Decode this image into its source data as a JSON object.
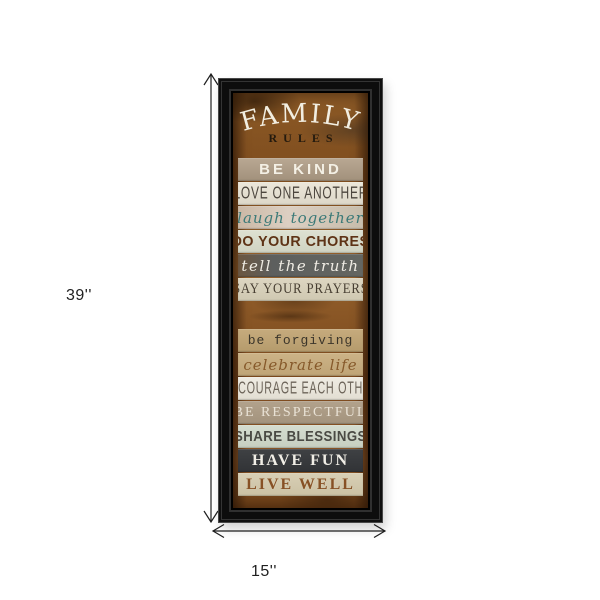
{
  "page": {
    "background": "#ffffff"
  },
  "dimensions": {
    "height_label": "39''",
    "width_label": "15''"
  },
  "artwork": {
    "title": "FAMILY",
    "subtitle": "RULES",
    "rules": [
      {
        "label": "BE KIND",
        "style": "be-kind"
      },
      {
        "label": "LOVE ONE ANOTHER",
        "style": "love-one-another"
      },
      {
        "label": "laugh together",
        "style": "laugh-together"
      },
      {
        "label": "DO YOUR CHORES",
        "style": "do-your-chores"
      },
      {
        "label": "tell the truth",
        "style": "tell-the-truth"
      },
      {
        "label": "SAY YOUR PRAYERS",
        "style": "say-your-prayers"
      },
      {
        "label": "",
        "style": "gap"
      },
      {
        "label": "be forgiving",
        "style": "be-forgiving"
      },
      {
        "label": "celebrate life",
        "style": "celebrate-life"
      },
      {
        "label": "ENCOURAGE EACH OTHER",
        "style": "encourage-each-other"
      },
      {
        "label": "BE RESPECTFUL",
        "style": "be-respectful"
      },
      {
        "label": "SHARE BLESSINGS",
        "style": "share-blessings"
      },
      {
        "label": "HAVE FUN",
        "style": "have-fun"
      },
      {
        "label": "LIVE WELL",
        "style": "live-well"
      }
    ]
  },
  "colors": {
    "frame": "#141414",
    "wood": "#84521f",
    "dimension_lines": "#1f1f1f"
  }
}
